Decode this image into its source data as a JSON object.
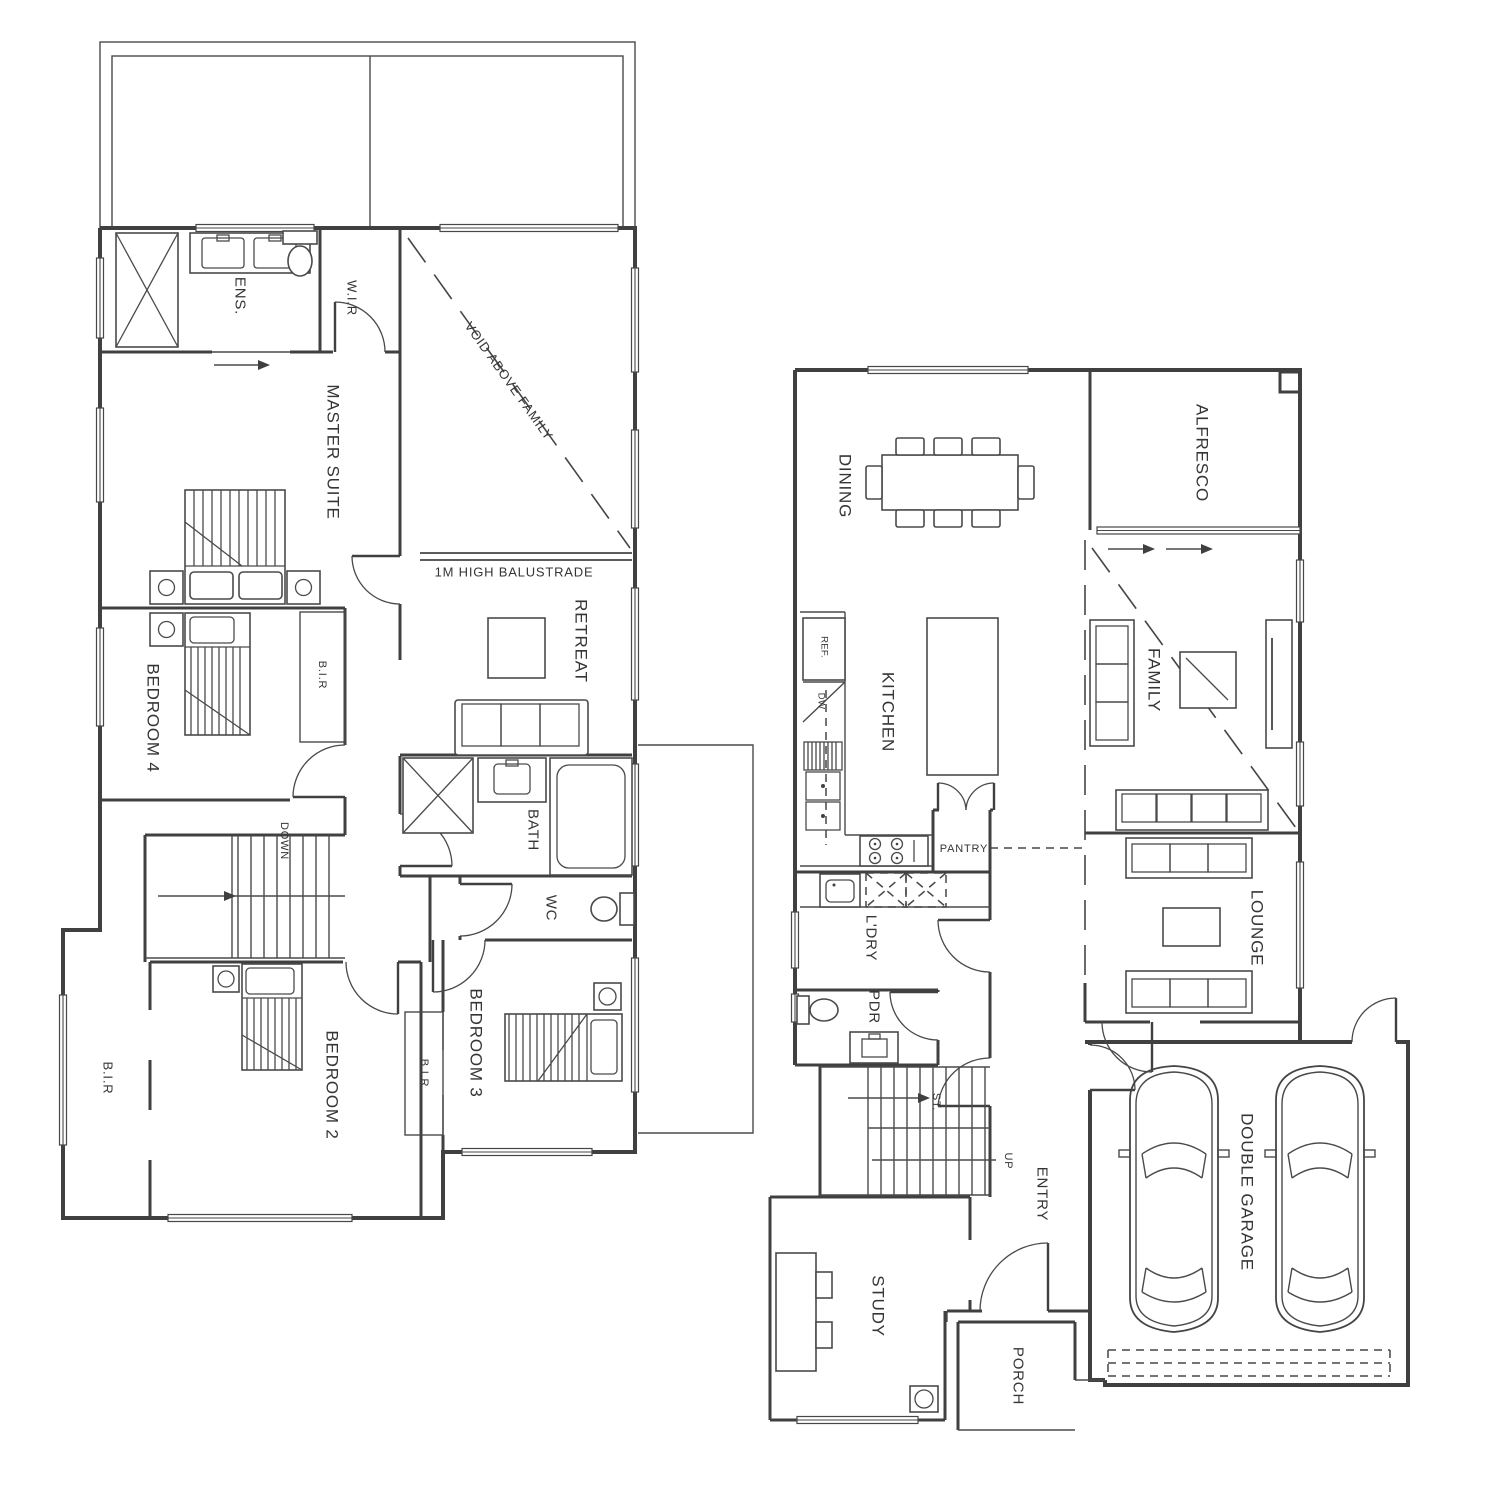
{
  "upper_floor": {
    "rooms": {
      "ens": "ENS.",
      "wir": "W.I.R",
      "master_suite": "MASTER SUITE",
      "retreat": "RETREAT",
      "bedroom_4": "BEDROOM 4",
      "bir_bedroom_4": "B.I.R",
      "bath": "BATH",
      "wc": "WC",
      "bedroom_2": "BEDROOM 2",
      "bir_bedroom_2": "B.I.R",
      "bedroom_3": "BEDROOM 3",
      "bir_bedroom_3": "B.I.R"
    },
    "annotations": {
      "void_above_family": "VOID ABOVE FAMILY",
      "balustrade": "1M HIGH BALUSTRADE",
      "down": "DOWN"
    }
  },
  "ground_floor": {
    "rooms": {
      "dining": "DINING",
      "alfresco": "ALFRESCO",
      "kitchen": "KITCHEN",
      "pantry": "PANTRY",
      "family": "FAMILY",
      "lounge": "LOUNGE",
      "laundry": "L'DRY",
      "powder": "PDR",
      "entry": "ENTRY",
      "study": "STUDY",
      "porch": "PORCH",
      "garage": "DOUBLE GARAGE"
    },
    "annotations": {
      "fridge": "REF.",
      "dishwasher": "DW",
      "stairs": "ST.",
      "up": "UP"
    }
  },
  "colors": {
    "line": "#404040",
    "text": "#353535",
    "background": "#ffffff"
  }
}
